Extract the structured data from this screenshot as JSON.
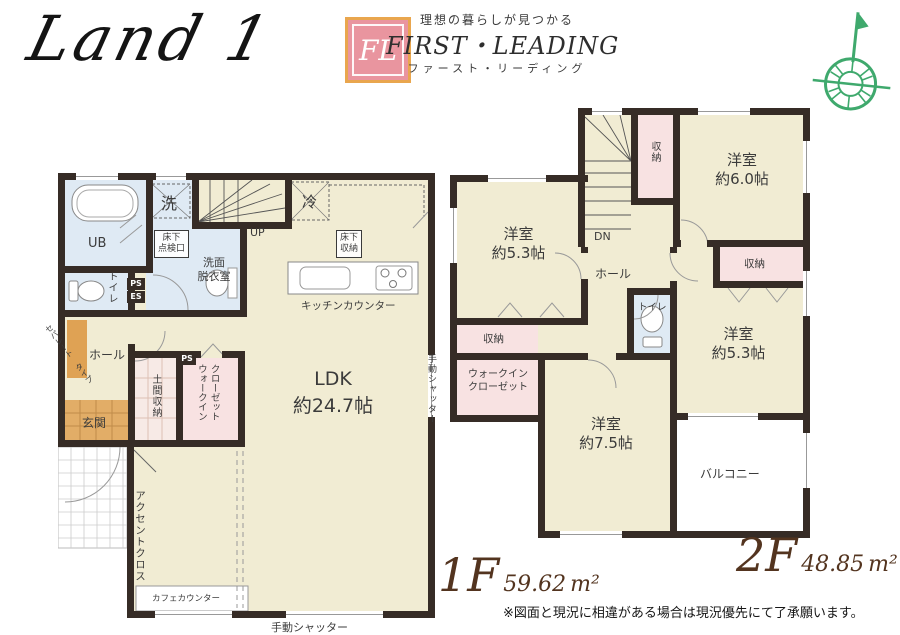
{
  "header": {
    "plan_title": "Land 1",
    "logo": {
      "monogram": "FL",
      "tagline": "理想の暮らしが見つかる",
      "brand_en": "FIRST・LEADING",
      "brand_ja": "ファースト・リーディング"
    }
  },
  "floor1": {
    "floor_label": "1F",
    "area": "59.62",
    "area_unit": "m²",
    "labels": {
      "ub": "UB",
      "washer": "洗",
      "laundry": "洗面\n脱衣室",
      "underfloor_hatch": "床下\n点検口",
      "toilet": "トイレ",
      "ps": "PS",
      "es": "ES",
      "hall": "ホール",
      "separate_type": "セパレート\nタイプ",
      "entrance": "玄関",
      "doma_storage": "土間収納",
      "ps2": "PS",
      "walk_in_closet": "ウォークイン\nクローゼット",
      "up": "UP",
      "fridge": "冷",
      "underfloor_storage": "床下\n収納",
      "kitchen_counter": "キッチンカウンター",
      "ldk": "LDK\n約24.7帖",
      "accent_cloth": "アクセントクロス",
      "cafe_counter": "カフェカウンター",
      "shutter_right": "手動シャッター",
      "shutter_bottom": "手動シャッター"
    }
  },
  "floor2": {
    "floor_label": "2F",
    "area": "48.85",
    "area_unit": "m²",
    "labels": {
      "storage_top": "収納",
      "room_6": "洋室\n約6.0帖",
      "room_53_left": "洋室\n約5.3帖",
      "dn": "DN",
      "hall": "ホール",
      "toilet": "トイレ",
      "storage_right": "収納",
      "room_53_right": "洋室\n約5.3帖",
      "storage_left": "収納",
      "walk_in_closet": "ウォークイン\nクローゼット",
      "room_75": "洋室\n約7.5帖",
      "balcony": "バルコニー"
    }
  },
  "footer": {
    "disclaimer": "※図面と現況に相違がある場合は現況優先にて了承願います。"
  }
}
